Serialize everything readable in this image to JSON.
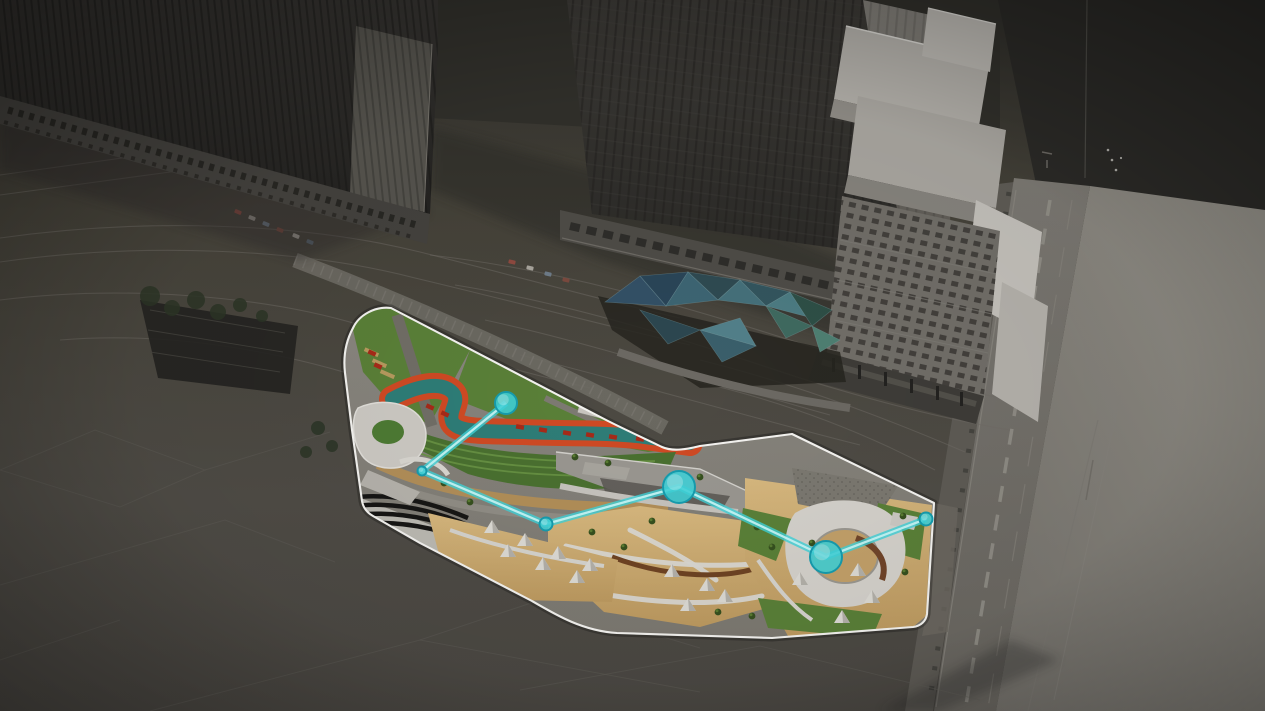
{
  "scene": {
    "overlay": {
      "kind": "route-with-waypoints",
      "node_count": 6
    }
  },
  "palette": {
    "accent": "#3fd2d8",
    "accent_light": "#c6f5f5",
    "accent_dark": "#169cae",
    "site_outline": "#f4f3f0",
    "lawn": "#5a8038",
    "terrace_green": "#4a7030",
    "plaza_tan": "#c9a76c",
    "ribbon_orange": "#cf4a24",
    "ribbon_teal": "#2e7d77",
    "model_dark": "#2b2a27",
    "model_mid": "#4a4743",
    "road_gray": "#73706a",
    "plaza_light": "#8f8c85",
    "building_light": "#b2afa9"
  },
  "route": {
    "line_color": "#3fd2d8",
    "nodes": [
      {
        "id": "waypoint-1",
        "x": 506,
        "y": 403,
        "r": 11,
        "size": "medium"
      },
      {
        "id": "waypoint-2",
        "x": 422,
        "y": 471,
        "r": 4.5,
        "size": "small"
      },
      {
        "id": "waypoint-3",
        "x": 546,
        "y": 524,
        "r": 6.5,
        "size": "small"
      },
      {
        "id": "waypoint-4",
        "x": 679,
        "y": 487,
        "r": 16,
        "size": "large"
      },
      {
        "id": "waypoint-5",
        "x": 826,
        "y": 557,
        "r": 16,
        "size": "large"
      },
      {
        "id": "waypoint-6",
        "x": 926,
        "y": 519,
        "r": 6.5,
        "size": "small"
      }
    ]
  }
}
